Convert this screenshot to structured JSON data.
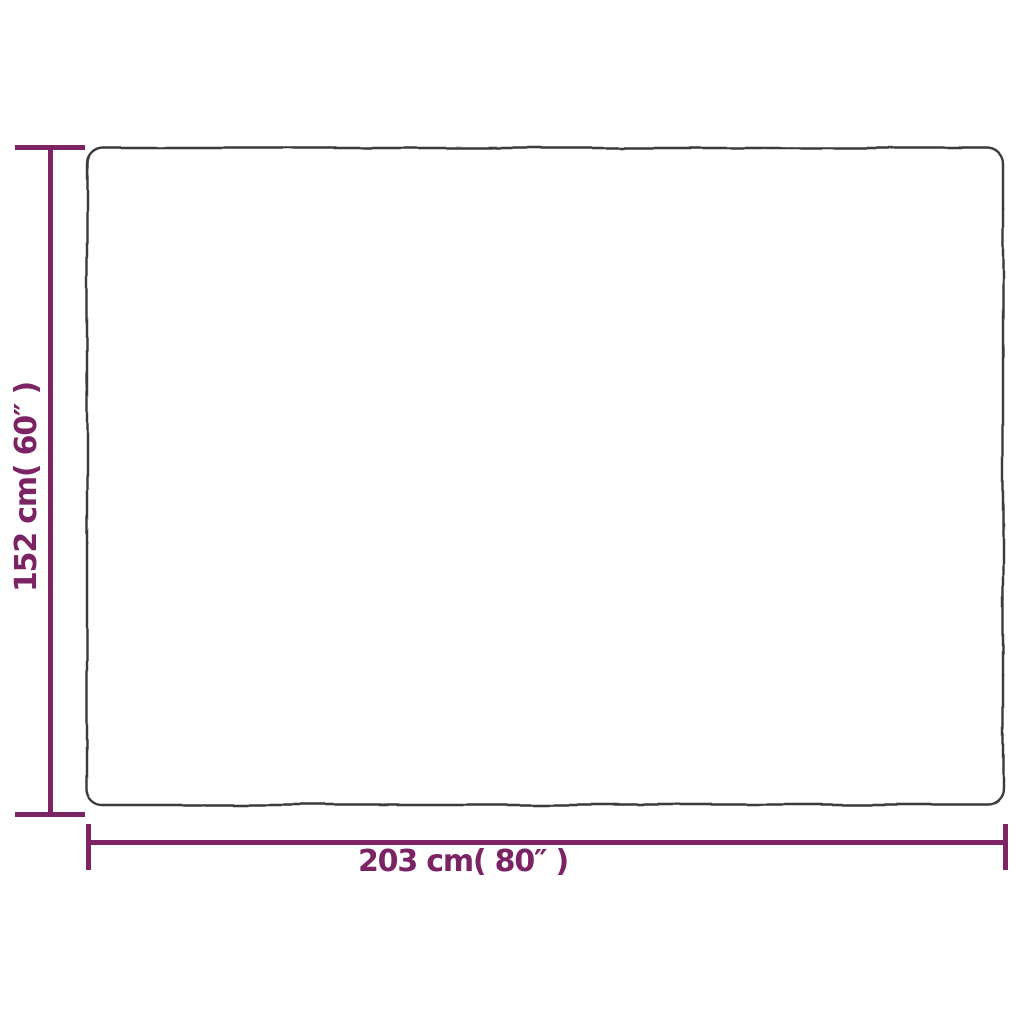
{
  "diagram": {
    "type": "product-dimension-diagram",
    "description": "White rectangular product outline with height and width measurement lines",
    "accent_color": "#7C2364",
    "outline_color": "#3A3A3A",
    "background_color": "#FFFFFF",
    "height_dimension": {
      "label": "152 cm( 60″ )",
      "value_cm": 152,
      "value_inches": 60
    },
    "width_dimension": {
      "label": "203 cm( 80″ )",
      "value_cm": 203,
      "value_inches": 80
    }
  }
}
